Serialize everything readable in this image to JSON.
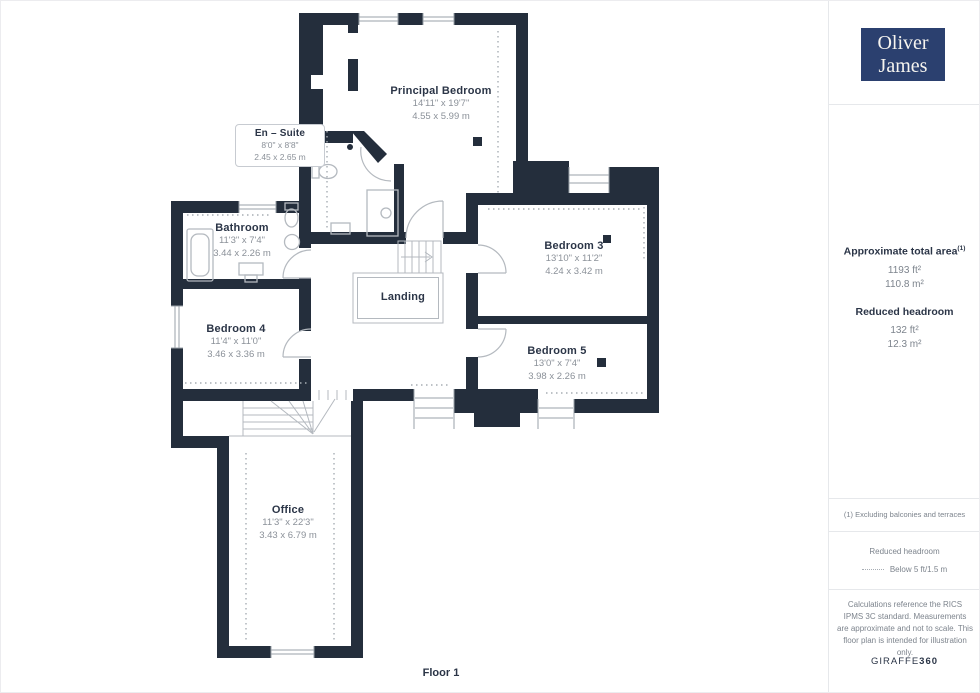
{
  "brand": {
    "logo_line1": "Oliver",
    "logo_line2": "James"
  },
  "plan": {
    "floor_label": "Floor 1",
    "rooms": [
      {
        "name": "Principal Bedroom",
        "dims_ft": "14'11\" x 19'7\"",
        "dims_m": "4.55 x 5.99 m"
      },
      {
        "name": "En – Suite",
        "dims_ft": "8'0\" x 8'8\"",
        "dims_m": "2.45 x 2.65 m"
      },
      {
        "name": "Bathroom",
        "dims_ft": "11'3\" x 7'4\"",
        "dims_m": "3.44 x 2.26 m"
      },
      {
        "name": "Bedroom 3",
        "dims_ft": "13'10\" x 11'2\"",
        "dims_m": "4.24 x 3.42 m"
      },
      {
        "name": "Bedroom 4",
        "dims_ft": "11'4\" x 11'0\"",
        "dims_m": "3.46 x 3.36 m"
      },
      {
        "name": "Bedroom 5",
        "dims_ft": "13'0\" x 7'4\"",
        "dims_m": "3.98 x 2.26 m"
      },
      {
        "name": "Landing"
      },
      {
        "name": "Office",
        "dims_ft": "11'3\" x 22'3\"",
        "dims_m": "3.43 x 6.79 m"
      }
    ]
  },
  "sidebar": {
    "total_area_label": "Approximate total area",
    "total_area_sup": "(1)",
    "total_area_ft": "1193 ft²",
    "total_area_m": "110.8 m²",
    "reduced_label": "Reduced headroom",
    "reduced_ft": "132 ft²",
    "reduced_m": "12.3 m²",
    "footnote": "(1) Excluding balconies and terraces",
    "legend_title": "Reduced headroom",
    "legend_item": "Below 5 ft/1.5 m",
    "disclaimer": "Calculations reference the RICS IPMS 3C standard. Measurements are approximate and not to scale. This floor plan is intended for illustration only.",
    "watermark_normal": "GIRAFFE",
    "watermark_bold": "360"
  },
  "colors": {
    "wall": "#242e3c",
    "logo_bg": "#2b406f",
    "label_text": "#2b3547",
    "dim_text": "#8b9199",
    "fixture_line": "#b4b9bf"
  }
}
